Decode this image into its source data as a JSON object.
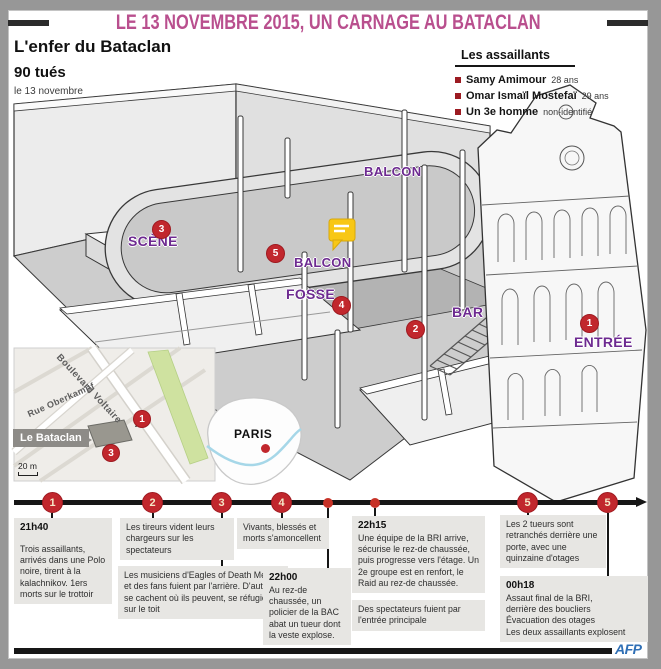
{
  "page": {
    "title_banner": "LE 13 NOVEMBRE 2015, UN CARNAGE AU BATACLAN",
    "credit": "AFP"
  },
  "header": {
    "subtitle": "L'enfer du Bataclan",
    "toll": "90 tués",
    "toll_date": "le 13 novembre"
  },
  "assailants": {
    "heading": "Les assaillants",
    "items": [
      {
        "name": "Samy Amimour",
        "detail": "28 ans"
      },
      {
        "name": "Omar Ismaïl Mostefaï",
        "detail": "29 ans"
      },
      {
        "name": "Un 3e homme",
        "detail": "non-identifié"
      }
    ]
  },
  "venue": {
    "labels": {
      "balcon_top": "BALCON",
      "balcon": "BALCON",
      "scene": "SCÈNE",
      "fosse": "FOSSE",
      "bar": "BAR",
      "entree": "ENTRÉE"
    },
    "markers": {
      "entree": "1",
      "bar": "2",
      "scene": "3",
      "fosse": "4",
      "balcon": "5"
    }
  },
  "map": {
    "street_1": "Boulevard Voltaire",
    "street_2": "Rue Oberkampf",
    "venue_label": "Le Bataclan",
    "scale": "20 m",
    "marker_entree": "1",
    "marker_scene": "3"
  },
  "paris_inset": {
    "label": "PARIS"
  },
  "timeline": {
    "marker_labels": [
      "1",
      "2",
      "3",
      "4",
      "5",
      "5"
    ],
    "events": [
      {
        "time": "21h40",
        "text": "Trois assaillants, arrivés dans une Polo noire, tirent à la kalachnikov. 1ers morts sur le trottoir"
      },
      {
        "time": "",
        "text": "Les tireurs vident leurs chargeurs sur les spectateurs"
      },
      {
        "time": "",
        "text": "Vivants, blessés et morts s'amoncellent"
      },
      {
        "time": "22h15",
        "text": "Une équipe de la BRI arrive, sécurise le rez-de chaussée, puis progresse vers l'étage. Un 2e groupe est en renfort, le Raid au rez-de chaussée."
      },
      {
        "time": "",
        "text": "Les 2 tueurs sont retranchés derrière une porte, avec une quinzaine d'otages"
      },
      {
        "time": "",
        "text": "Les musiciens d'Eagles of Death Metal et des fans fuient par l'arrière. D'autres se cachent où ils peuvent, se réfugient sur le toit"
      },
      {
        "time": "22h00",
        "text": "Au rez-de chaussée, un policier de la BAC abat un tueur dont la veste explose."
      },
      {
        "time": "",
        "text": "Des spectateurs fuient par l'entrée principale"
      },
      {
        "time": "00h18",
        "text": "Assaut final de la BRI,\nderrière des boucliers\nÉvacuation des otages\nLes deux assaillants explosent"
      }
    ]
  }
}
